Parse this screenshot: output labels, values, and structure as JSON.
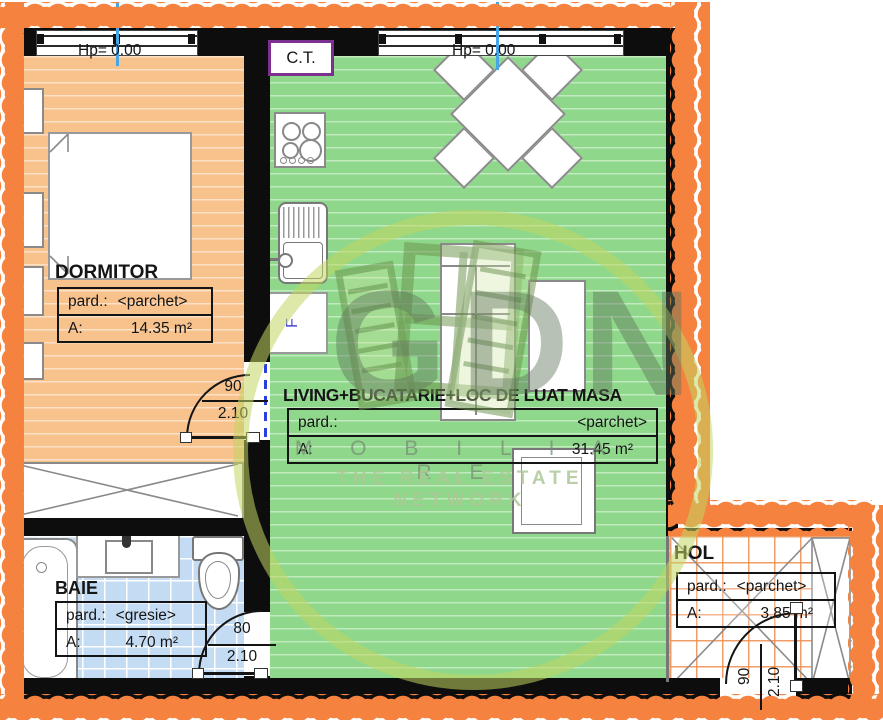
{
  "plan": {
    "watermark": {
      "logo": "GDN",
      "line1": "M O B I L I A R E",
      "line2": "THE REAL ESTATE NETWORK"
    },
    "boiler_label": "C.T.",
    "fridge_label": "F",
    "rooms": {
      "dormitor": {
        "name": "DORMITOR",
        "hp": "Hp= 0.00",
        "pard_label": "pard.:",
        "pard_value": "<parchet>",
        "area_label": "A:",
        "area_value": "14.35 m²"
      },
      "living": {
        "name": "LIVING+BUCATARIE+LOC DE LUAT MASA",
        "hp": "Hp= 0.00",
        "pard_label": "pard.:",
        "pard_value": "<parchet>",
        "area_label": "A:",
        "area_value": "31.45 m²"
      },
      "baie": {
        "name": "BAIE",
        "pard_label": "pard.:",
        "pard_value": "<gresie>",
        "area_label": "A:",
        "area_value": "4.70 m²"
      },
      "hol": {
        "name": "HOL",
        "pard_label": "pard.:",
        "pard_value": "<parchet>",
        "area_label": "A:",
        "area_value": "3.85 m²"
      }
    },
    "doors": {
      "dormitor": {
        "width": "90",
        "height": "2.10"
      },
      "baie": {
        "width": "80",
        "height": "2.10"
      },
      "entrance": {
        "width": "90",
        "height": "2.10"
      }
    },
    "colors": {
      "floor_dormitor": "#f8c28d",
      "floor_living": "#8fd88b",
      "floor_baie": "#c3dcf4",
      "floor_hol_grid": "#ef8c4e",
      "insulation_orange": "#f5823f",
      "wall_black": "#0d0d0d",
      "ct_border_purple": "#7b2f8e",
      "window_axis_blue": "#45a7e8",
      "door_axis_blue": "#2b3fe0",
      "watermark_green": "#c1d563"
    }
  }
}
